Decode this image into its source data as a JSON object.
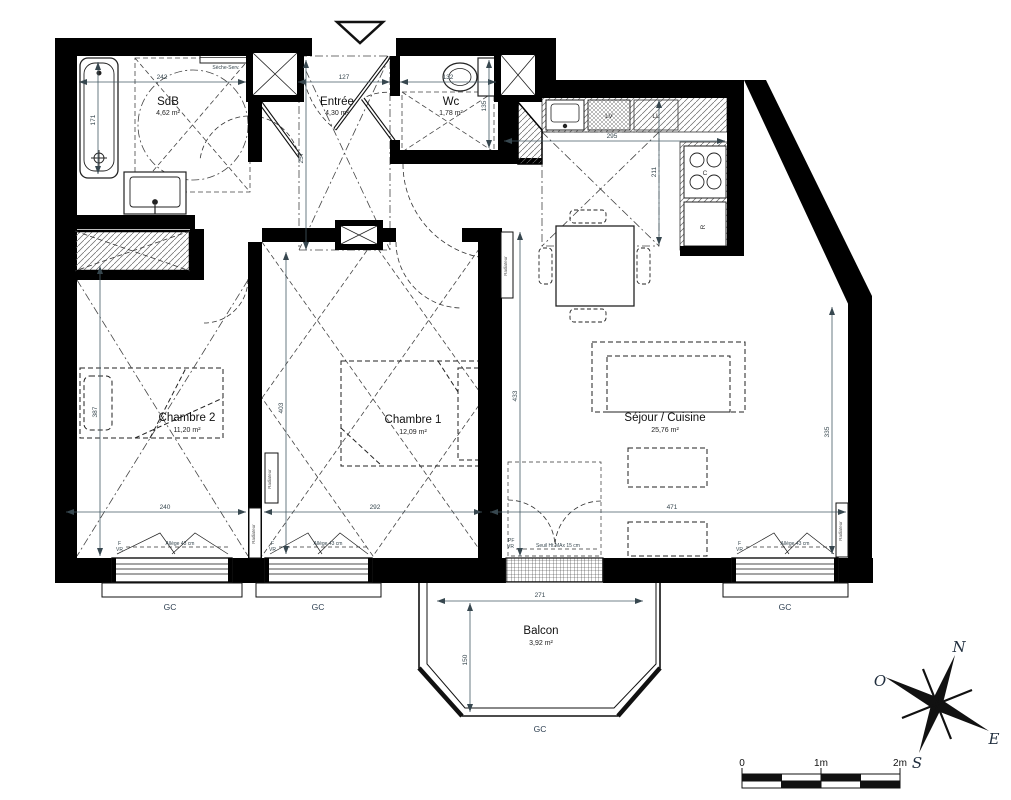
{
  "rooms": {
    "sdb": {
      "name": "SdB",
      "area": "4,62 m²"
    },
    "entree": {
      "name": "Entrée",
      "area": "4,30 m²"
    },
    "wc": {
      "name": "Wc",
      "area": "1,78 m²"
    },
    "chambre2": {
      "name": "Chambre 2",
      "area": "11,20 m²"
    },
    "chambre1": {
      "name": "Chambre 1",
      "area": "12,09 m²"
    },
    "sejour": {
      "name": "Séjour / Cuisine",
      "area": "25,76 m²"
    },
    "balcon": {
      "name": "Balcon",
      "area": "3,92 m²"
    }
  },
  "dims": {
    "sdb_w": "242",
    "sdb_h": "171",
    "entree_w": "127",
    "entree_h": "257",
    "wc_w": "132",
    "wc_h": "135",
    "cuisine_w": "295",
    "cuisine_h": "211",
    "ch2_w": "240",
    "ch2_h": "387",
    "ch1_side": "403",
    "ch1_w": "292",
    "sejour_side": "433",
    "sejour_w": "471",
    "sejour_h": "335",
    "balcon_w": "271",
    "balcon_h": "150"
  },
  "appliances": {
    "dishwasher": "LV",
    "washer": "LL",
    "hob": "C",
    "fridge": "R"
  },
  "equipment": {
    "radiator": "Radiateur",
    "towel_dryer": "Sèche-Serv."
  },
  "windows": {
    "f": "F",
    "vr": "VR",
    "allege": "Allège 43 cm",
    "pf": "PF",
    "seuil": "Seuil Ht MAx 15 cm",
    "gc": "GC"
  },
  "compass": {
    "n": "N",
    "e": "E",
    "s": "S",
    "o": "O"
  },
  "scalebar": {
    "zero": "0",
    "one": "1m",
    "two": "2m"
  }
}
